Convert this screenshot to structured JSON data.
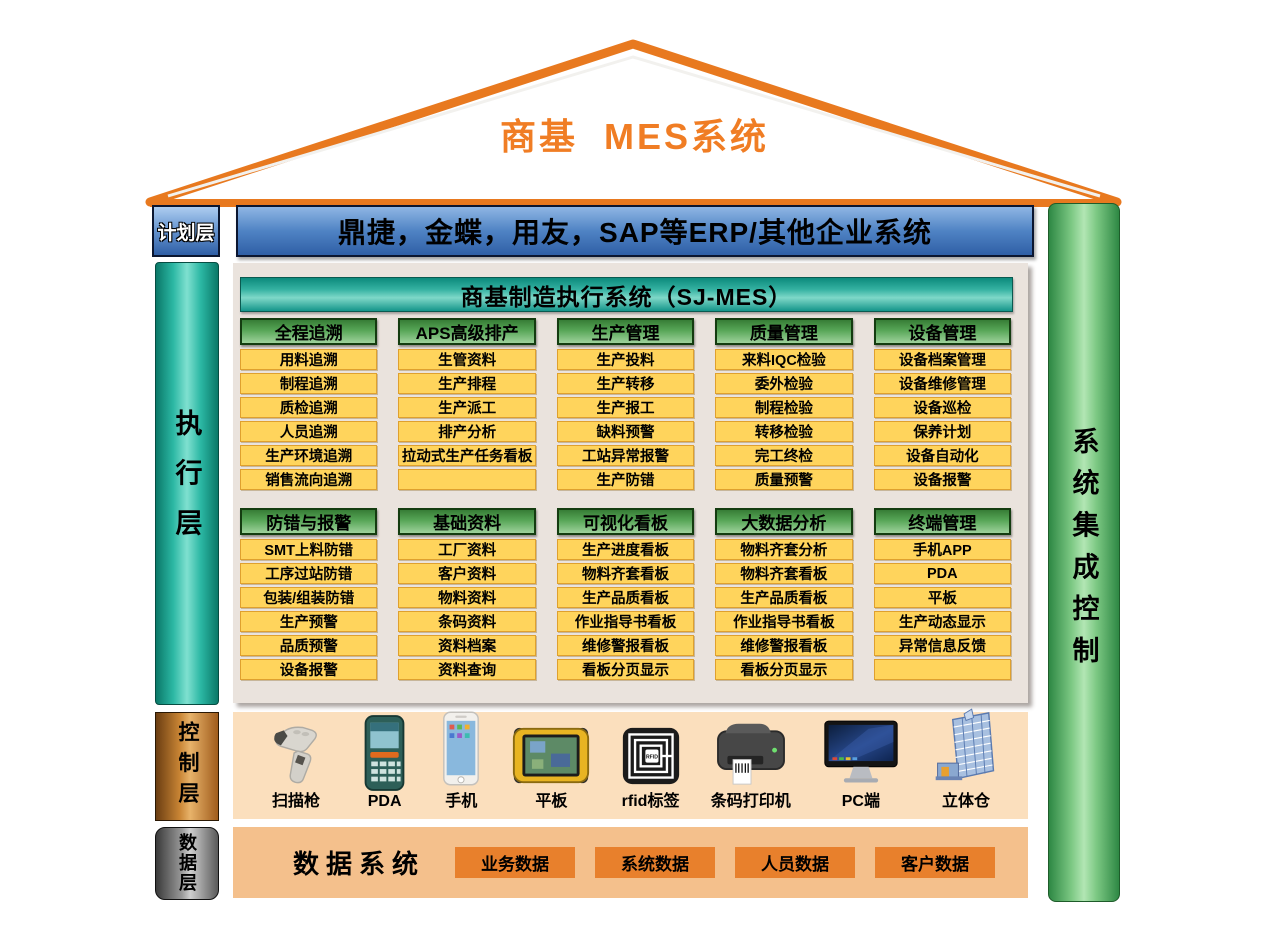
{
  "roof": {
    "title": "商基  MES系统"
  },
  "erp_bar": {
    "text": "鼎捷，金蝶，用友，SAP等ERP/其他企业系统"
  },
  "layers": {
    "plan": {
      "label": "计划层"
    },
    "execution": {
      "label": "执行层"
    },
    "control": {
      "label": "控制层"
    },
    "data": {
      "label": "数据层"
    }
  },
  "side_bar": {
    "label": "系统集成控制"
  },
  "mes_panel": {
    "title": "商基制造执行系统（SJ-MES）",
    "rows": [
      [
        {
          "header": "全程追溯",
          "items": [
            "用料追溯",
            "制程追溯",
            "质检追溯",
            "人员追溯",
            "生产环境追溯",
            "销售流向追溯"
          ]
        },
        {
          "header": "APS高级排产",
          "items": [
            "生管资料",
            "生产排程",
            "生产派工",
            "排产分析",
            "拉动式生产任务看板",
            ""
          ]
        },
        {
          "header": "生产管理",
          "items": [
            "生产投料",
            "生产转移",
            "生产报工",
            "缺料预警",
            "工站异常报警",
            "生产防错"
          ]
        },
        {
          "header": "质量管理",
          "items": [
            "来料IQC检验",
            "委外检验",
            "制程检验",
            "转移检验",
            "完工终检",
            "质量预警"
          ]
        },
        {
          "header": "设备管理",
          "items": [
            "设备档案管理",
            "设备维修管理",
            "设备巡检",
            "保养计划",
            "设备自动化",
            "设备报警"
          ]
        }
      ],
      [
        {
          "header": "防错与报警",
          "items": [
            "SMT上料防错",
            "工序过站防错",
            "包装/组装防错",
            "生产预警",
            "品质预警",
            "设备报警"
          ]
        },
        {
          "header": "基础资料",
          "items": [
            "工厂资料",
            "客户资料",
            "物料资料",
            "条码资料",
            "资料档案",
            "资料查询"
          ]
        },
        {
          "header": "可视化看板",
          "items": [
            "生产进度看板",
            "物料齐套看板",
            "生产品质看板",
            "作业指导书看板",
            "维修警报看板",
            "看板分页显示"
          ]
        },
        {
          "header": "大数据分析",
          "items": [
            "物料齐套分析",
            "物料齐套看板",
            "生产品质看板",
            "作业指导书看板",
            "维修警报看板",
            "看板分页显示"
          ]
        },
        {
          "header": "终端管理",
          "items": [
            "手机APP",
            "PDA",
            "平板",
            "生产动态显示",
            "异常信息反馈",
            ""
          ]
        }
      ]
    ]
  },
  "control_band": {
    "devices": [
      {
        "label": "扫描枪",
        "icon": "barcode-scanner-icon"
      },
      {
        "label": "PDA",
        "icon": "pda-icon"
      },
      {
        "label": "手机",
        "icon": "smartphone-icon"
      },
      {
        "label": "平板",
        "icon": "rugged-tablet-icon"
      },
      {
        "label": "rfid标签",
        "icon": "rfid-tag-icon"
      },
      {
        "label": "条码打印机",
        "icon": "label-printer-icon"
      },
      {
        "label": "PC端",
        "icon": "desktop-pc-icon"
      },
      {
        "label": "立体仓",
        "icon": "warehouse-icon"
      }
    ]
  },
  "data_band": {
    "title": "数据系统",
    "buttons": [
      "业务数据",
      "系统数据",
      "人员数据",
      "客户数据"
    ]
  },
  "colors": {
    "accent_orange": "#F07D24",
    "erp_blue": "#4F83C4",
    "teal_bar": "#2CB8A4",
    "green_bar": "#7CC883",
    "header_green": "#57A657",
    "module_yellow": "#FFD45C",
    "module_border": "#DFA02E",
    "panel_gray": "#EAE3DD",
    "device_band_peach": "#FBDFBD",
    "data_band_tan": "#F4C08C",
    "data_button_orange": "#E8802C"
  }
}
